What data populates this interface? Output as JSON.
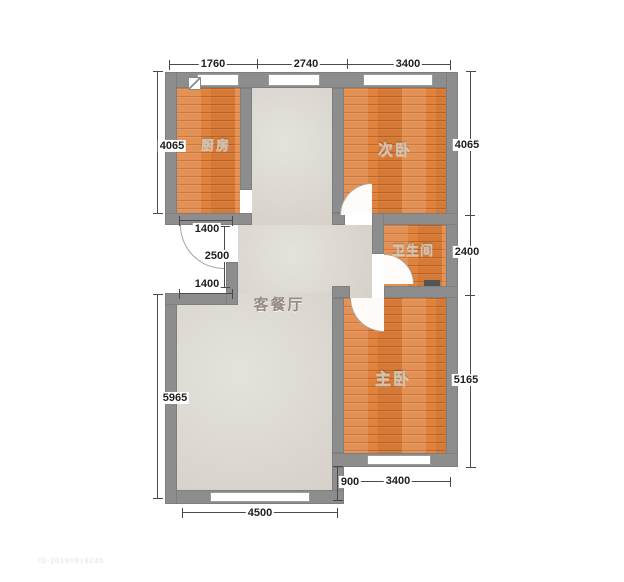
{
  "rooms": {
    "kitchen": "厨房",
    "secondary_bedroom": "次卧",
    "bathroom": "卫生间",
    "living_dining": "客餐厅",
    "master_bedroom": "主卧"
  },
  "dimensions": {
    "top_kitchen": "1760",
    "top_living": "2740",
    "top_secondary": "3400",
    "left_kitchen": "4065",
    "entry_width_top": "1400",
    "entry_height": "2500",
    "entry_width_bottom": "1400",
    "left_living": "5965",
    "right_secondary": "4065",
    "right_bathroom": "2400",
    "right_master": "5165",
    "bottom_living": "4500",
    "bottom_step": "900",
    "bottom_master": "3400"
  },
  "colors": {
    "wall": "#8d8d8d",
    "wood_floor": "#e0813c",
    "tile_floor": "#dcd8d0",
    "dimension_text": "#1f1f1f"
  },
  "watermark": "ID-20160819245"
}
